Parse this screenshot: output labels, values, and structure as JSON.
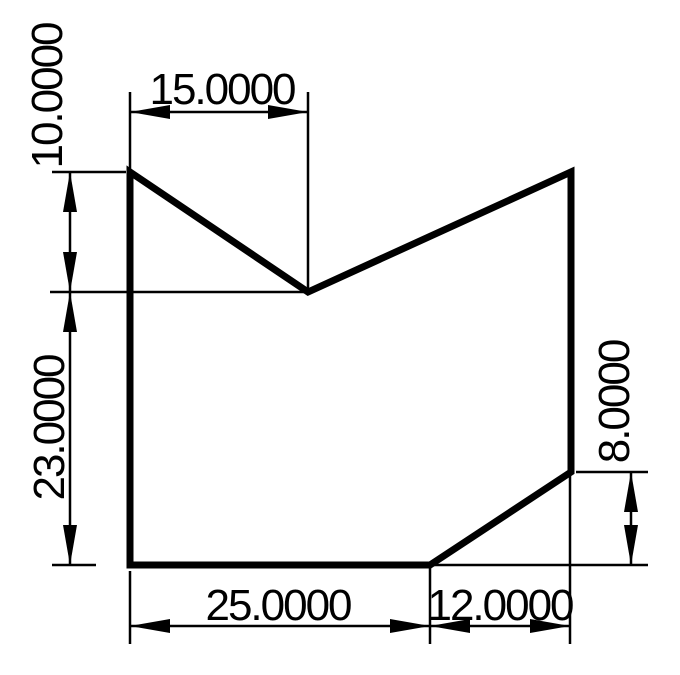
{
  "page": {
    "background": "#ffffff"
  },
  "drawing": {
    "type": "technical-dimension-drawing",
    "stroke_color": "#000000",
    "shape": {
      "description": "polygon with v-notch top and chamfered bottom-right corner",
      "points_string": "130,172 308,292 571,172 571,472 430,565 130,565"
    },
    "dimensions": [
      {
        "id": "top-width",
        "label": "15.0000",
        "orientation": "horizontal"
      },
      {
        "id": "upper-left-height",
        "label": "10.0000",
        "orientation": "vertical"
      },
      {
        "id": "lower-left-height",
        "label": "23.0000",
        "orientation": "vertical"
      },
      {
        "id": "right-height",
        "label": "8.0000",
        "orientation": "vertical"
      },
      {
        "id": "bottom-left-width",
        "label": "25.0000",
        "orientation": "horizontal"
      },
      {
        "id": "bottom-right-width",
        "label": "12.0000",
        "orientation": "horizontal"
      }
    ]
  }
}
